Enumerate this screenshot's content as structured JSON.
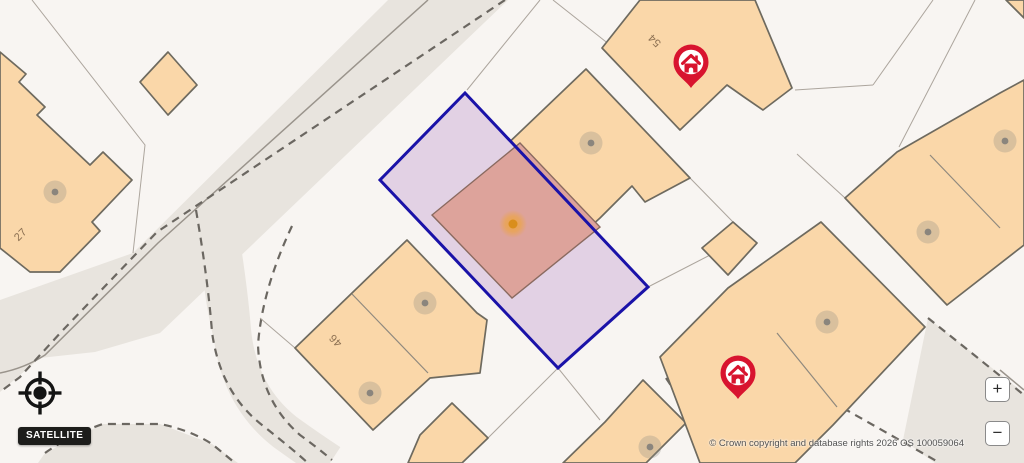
{
  "map": {
    "attribution": "© Crown copyright and database rights 2026 OS 100059064",
    "house_numbers": [
      {
        "text": "27"
      },
      {
        "text": "54"
      },
      {
        "text": "46"
      }
    ],
    "markers": {
      "property_pins": 2,
      "selected_plot_point": 1
    },
    "colors": {
      "background": "#F8F5F2",
      "road_fill": "#E8E4DE",
      "building_fill": "#FAD7A9",
      "building_outline": "#6E6A5F",
      "highlight_fill": "#E2D1E4",
      "highlight_building_fill": "#DDA39B",
      "highlight_border": "#1A12A8",
      "pin_red": "#D8142F",
      "marker_orange": "#D98E1C"
    }
  },
  "controls": {
    "satellite_label": "SATELLITE",
    "zoom_in_label": "+",
    "zoom_out_label": "−"
  }
}
